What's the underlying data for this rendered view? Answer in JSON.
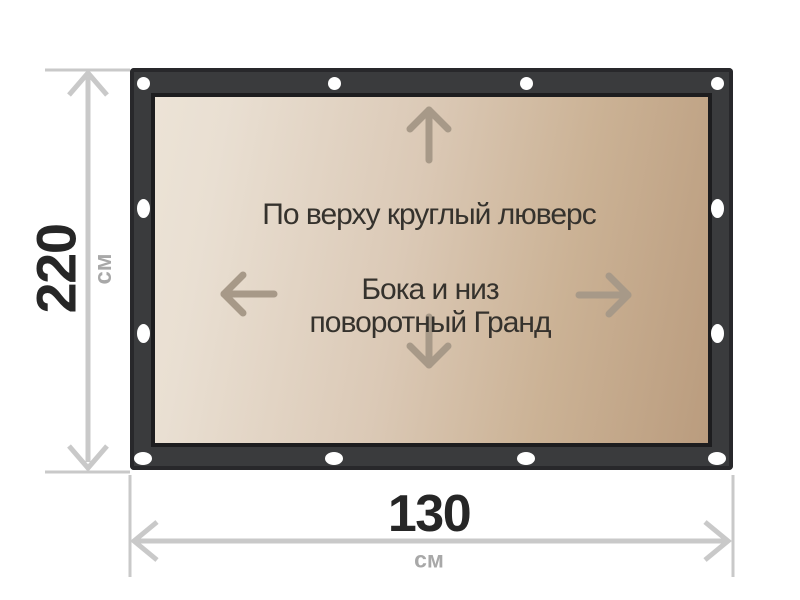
{
  "page": {
    "background_color": "#ffffff",
    "type": "product-dimension-diagram"
  },
  "banner": {
    "notes": {
      "top": "По верху круглый люверс",
      "center_line1": "Бока и низ",
      "center_line2": "поворотный Гранд"
    },
    "grommet_count": 12,
    "grommet_color": "#ffffff",
    "colors": {
      "frame": "#3a3b3d",
      "frame_outline": "#28282b",
      "panel_border": "#1d1d1f",
      "panel_gradient_light": "#ece3d6",
      "panel_gradient_dark": "#ba9c7e",
      "inner_arrow": "#a79988",
      "note_text": "#35322d"
    },
    "icons": [
      "up-arrow-icon",
      "down-arrow-icon",
      "left-arrow-icon",
      "right-arrow-icon"
    ]
  },
  "dimensions": {
    "height": {
      "value": "220",
      "unit": "см"
    },
    "width": {
      "value": "130",
      "unit": "см"
    },
    "line_color": "#c9c9c9",
    "value_text_color": "#262626",
    "unit_text_color": "#a8a8a8"
  }
}
